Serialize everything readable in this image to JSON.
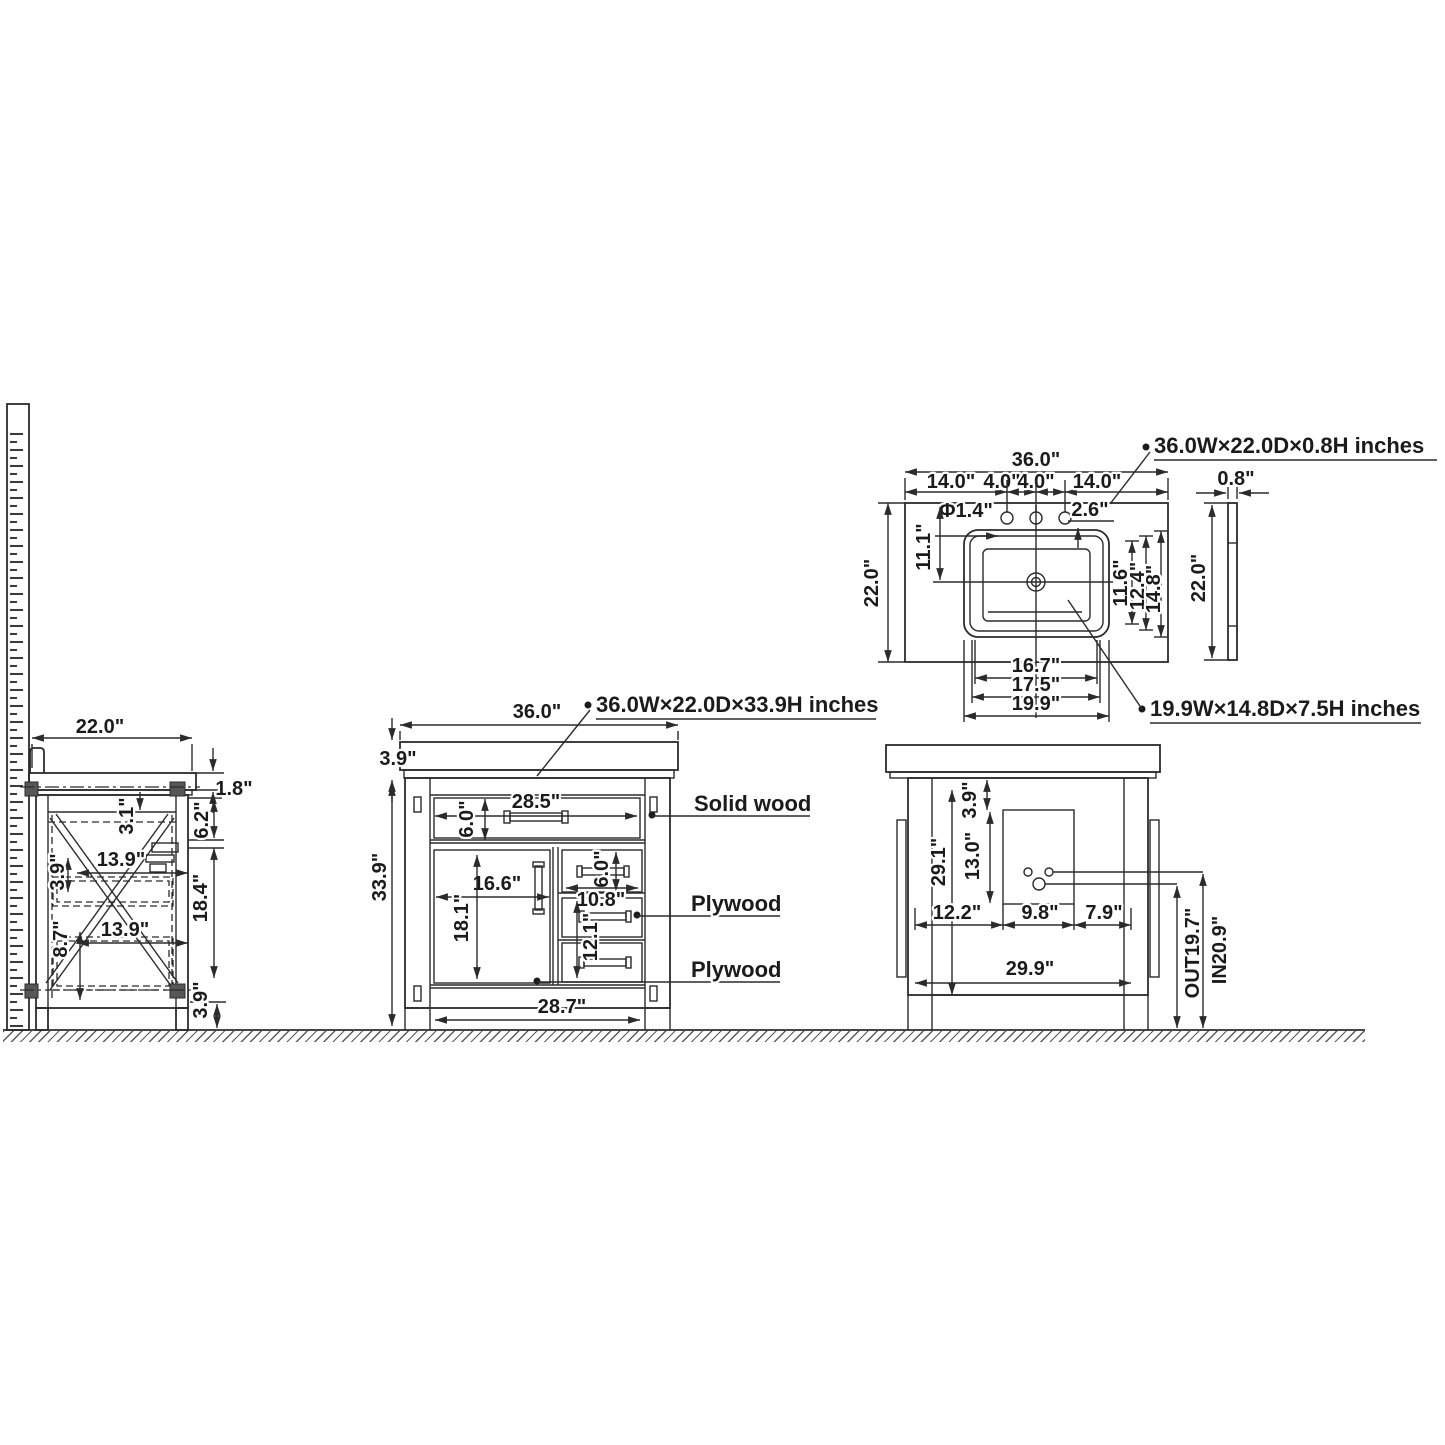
{
  "annotations": {
    "vanity_size": "36.0W×22.0D×33.9H inches",
    "countertop_size": "36.0W×22.0D×0.8H inches",
    "sink_size": "19.9W×14.8D×7.5H inches",
    "solid_wood": "Solid wood",
    "plywood_1": "Plywood",
    "plywood_2": "Plywood"
  },
  "side_view": {
    "width": "22.0\"",
    "counter_thickness": "1.8\"",
    "top_offset": "3.1\"",
    "slide_length_top": "13.9\"",
    "side_gap": "3.9\"",
    "bottom_offset": "8.7\"",
    "slide_length_bottom": "13.9\"",
    "rail_gap": "6.2\"",
    "drawer_zone_height": "18.4\"",
    "leg_height": "3.9\""
  },
  "front_view": {
    "width": "36.0\"",
    "counter_height": "3.9\"",
    "total_height": "33.9\"",
    "top_drawer_width": "28.5\"",
    "top_drawer_height": "6.0\"",
    "door_width": "16.6\"",
    "door_height": "18.1\"",
    "right_drawer_height": "6.0\"",
    "right_drawer_width": "10.8\"",
    "lower_drawer_height": "12.1\"",
    "base_width": "28.7\""
  },
  "back_view": {
    "interior_height": "29.1\"",
    "panel_top_offset": "3.9\"",
    "cutout_height": "13.0\"",
    "left_offset": "12.2\"",
    "cutout_width": "9.8\"",
    "right_offset": "7.9\"",
    "base_width": "29.9\"",
    "inlet_height": "IN20.9\"",
    "outlet_height": "OUT19.7\""
  },
  "top_view": {
    "width": "36.0\"",
    "left_span": "14.0\"",
    "hole_span_1": "4.0\"",
    "hole_span_2": "4.0\"",
    "right_span": "14.0\"",
    "depth": "22.0\"",
    "hole_diameter": "Φ1.4\"",
    "hole_edge_gap": "2.6\"",
    "front_to_center": "11.1\"",
    "sink_inner_depth": "11.6\"",
    "sink_mid_depth": "12.4\"",
    "sink_outer_depth": "14.8\"",
    "sink_inner_width": "16.7\"",
    "sink_mid_width": "17.5\"",
    "sink_outer_width": "19.9\""
  },
  "profile_view": {
    "thickness": "0.8\"",
    "depth": "22.0\""
  }
}
